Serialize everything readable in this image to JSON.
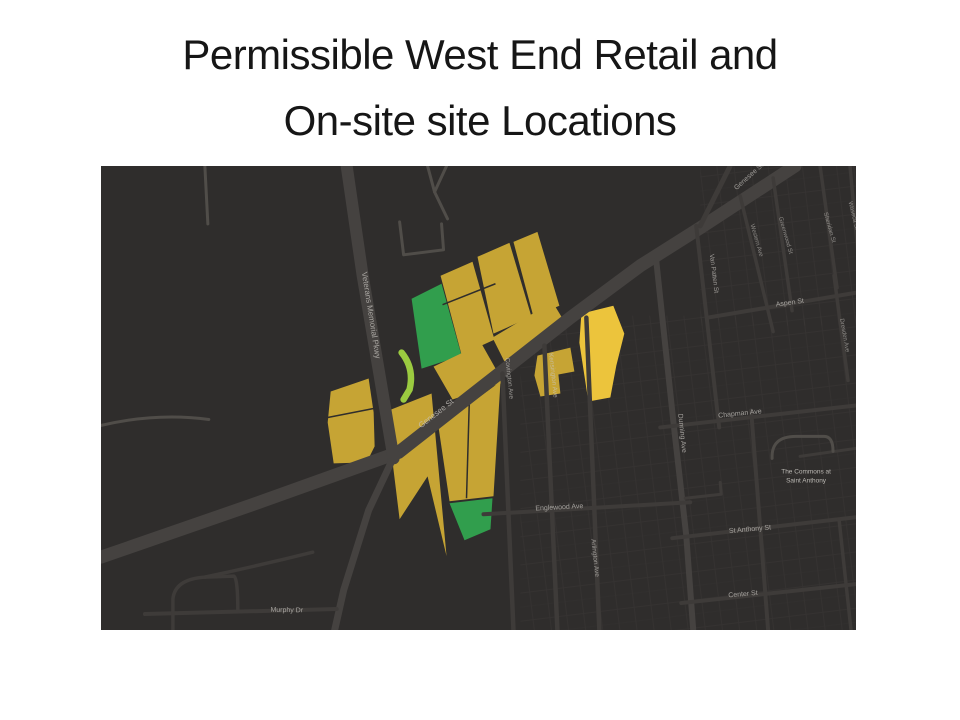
{
  "slide": {
    "title_line1": "Permissible West End Retail and",
    "title_line2": "On-site site Locations"
  },
  "map": {
    "colors": {
      "background": "#2f2d2c",
      "road_major": "#454240",
      "road_minor": "#3e3b39",
      "road_faint": "#504d49",
      "block_grid": "#3a3736",
      "label": "#c9c6c1",
      "gold": "#c6a434",
      "yellow": "#ecc43c",
      "green": "#319e4d",
      "lightgreen": "#9bcb40"
    },
    "textures": [
      {
        "name": "blocks-bottom-center",
        "x": 420,
        "y": 150,
        "w": 336,
        "h": 315
      },
      {
        "name": "blocks-top-right",
        "x": 600,
        "y": 0,
        "w": 156,
        "h": 160
      }
    ],
    "parcels": [
      {
        "name": "parcel-green-upper",
        "fill": "green",
        "pts": "311,133 341,118 361,190 321,203"
      },
      {
        "name": "parcel-gold-a",
        "fill": "gold",
        "pts": "340,110 372,96 394,174 361,189"
      },
      {
        "name": "parcel-gold-b",
        "fill": "gold",
        "pts": "377,91 409,77 431,151 393,168"
      },
      {
        "name": "parcel-gold-c",
        "fill": "gold",
        "pts": "413,76 437,66 459,140 433,151"
      },
      {
        "name": "parcel-gold-d",
        "fill": "gold",
        "pts": "392,172 452,136 464,156 404,196"
      },
      {
        "name": "parcel-gold-e",
        "fill": "gold",
        "pts": "333,201 381,178 403,217 352,234"
      },
      {
        "name": "parcel-gold-f",
        "fill": "gold",
        "pts": "437,190 470,182 474,206 458,209 460,228 440,231 434,210"
      },
      {
        "name": "parcel-yellow-bright",
        "fill": "yellow",
        "pts": "481,148 513,140 524,168 516,200 510,232 488,236 479,177"
      },
      {
        "name": "parcel-gold-h",
        "fill": "gold",
        "pts": "230,226 268,213 273,247 274,281 266,297 233,298 227,257"
      },
      {
        "name": "parcel-gold-i",
        "fill": "gold",
        "pts": "283,247 331,228 346,391 327,311 299,354 291,289"
      },
      {
        "name": "parcel-gold-j",
        "fill": "gold",
        "pts": "338,262 400,216 393,331 349,336"
      },
      {
        "name": "parcel-green-lower",
        "fill": "green",
        "pts": "349,338 392,333 390,364 364,375"
      }
    ],
    "sliver": {
      "name": "parcel-lightgreen-sliver",
      "d": "M301,187 Q314,203 309,224 L303,234",
      "w": 6.5,
      "fill": "lightgreen"
    },
    "splits": [
      "M227,252 L273,243",
      "M369,229 L366,333",
      "M342,139 L395,118"
    ],
    "roads": [
      {
        "name": "genesee-st",
        "d": "M0,392 L150,340 L298,287 L470,152 L540,100 L600,62 L695,0",
        "w": 13,
        "c": "road_major"
      },
      {
        "name": "veterans-memorial-pkwy-upper",
        "d": "M246,0 L262,110 L279,210 L293,293",
        "w": 12,
        "c": "road_major"
      },
      {
        "name": "veterans-memorial-pkwy-lower",
        "d": "M291,296 L268,345 L243,425 L234,465",
        "w": 7,
        "c": "road_major"
      },
      {
        "name": "genesee-branch",
        "d": "M600,60 L630,0",
        "w": 5,
        "c": "road_minor"
      },
      {
        "name": "covington-ave",
        "d": "M402,208 L413,465",
        "w": 4.5,
        "c": "road_minor"
      },
      {
        "name": "kensington-ave",
        "d": "M444,180 L457,465",
        "w": 4.5,
        "c": "road_minor"
      },
      {
        "name": "arlington-ave",
        "d": "M486,152 L499,465",
        "w": 4.5,
        "c": "road_minor"
      },
      {
        "name": "dunning-ave",
        "d": "M556,95 L573,255 L586,370 L593,465",
        "w": 6,
        "c": "road_major"
      },
      {
        "name": "englewood-ave",
        "d": "M383,349 L590,337",
        "w": 4,
        "c": "road_minor"
      },
      {
        "name": "chapman-ave",
        "d": "M560,262 L756,240",
        "w": 4,
        "c": "road_minor"
      },
      {
        "name": "st-anthony-st",
        "d": "M572,373 L756,352",
        "w": 4,
        "c": "road_minor"
      },
      {
        "name": "center-st",
        "d": "M581,438 L756,419",
        "w": 4,
        "c": "road_minor"
      },
      {
        "name": "aspen-st",
        "d": "M607,152 L756,127",
        "w": 4,
        "c": "road_minor"
      },
      {
        "name": "van-patten-st",
        "d": "M596,60 L619,262",
        "w": 4,
        "c": "road_minor"
      },
      {
        "name": "western-ave",
        "d": "M640,30 L673,166",
        "w": 3.5,
        "c": "road_minor"
      },
      {
        "name": "greenwood-st",
        "d": "M673,12 L692,145",
        "w": 3.5,
        "c": "road_minor"
      },
      {
        "name": "sheridan-st",
        "d": "M720,0 L737,122",
        "w": 3.5,
        "c": "road_minor"
      },
      {
        "name": "dresden-ave",
        "d": "M734,110 L748,215",
        "w": 3.5,
        "c": "road_minor"
      },
      {
        "name": "waseca-st",
        "d": "M750,0 L760,110",
        "w": 3.5,
        "c": "road_minor"
      },
      {
        "name": "right-vertical-st",
        "d": "M651,245 L668,465",
        "w": 4,
        "c": "road_minor"
      },
      {
        "name": "right-lower-vertical-st",
        "d": "M739,354 L751,465",
        "w": 3.5,
        "c": "road_minor"
      },
      {
        "name": "right-mid-horizontal-st",
        "d": "M700,291 L756,283",
        "w": 3,
        "c": "road_minor"
      },
      {
        "name": "st-anthony-hook-st",
        "d": "M585,333 L621,329 L620,317",
        "w": 3,
        "c": "road_minor"
      },
      {
        "name": "murphy-dr",
        "d": "M44,449 L236,444",
        "w": 4,
        "c": "road_minor"
      },
      {
        "name": "bottomleft-loop-rd",
        "d": "M72,465 L72,434 Q74,414 104,412 L133,411 Q137,413 137,446",
        "w": 3.5,
        "c": "road_minor"
      },
      {
        "name": "bottomleft-spur-rd",
        "d": "M104,412 Q160,400 212,387",
        "w": 3.5,
        "c": "road_minor"
      },
      {
        "name": "left-faint-curve-rd",
        "d": "M0,260 Q55,247 108,254",
        "w": 3,
        "c": "road_faint"
      },
      {
        "name": "topleft-faint-vert-rd",
        "d": "M104,0 L107,58",
        "w": 3,
        "c": "road_faint"
      },
      {
        "name": "top-u-rd",
        "d": "M299,56 L303,89 L343,84 L341,58",
        "w": 3,
        "c": "road_faint"
      },
      {
        "name": "top-y-rd",
        "d": "M327,0 L334,26 L347,53",
        "w": 3,
        "c": "road_faint"
      },
      {
        "name": "top-y-branch-rd",
        "d": "M346,0 L334,26",
        "w": 3,
        "c": "road_faint"
      },
      {
        "name": "commons-loop-rd",
        "d": "M672,293 Q671,271 696,271 L724,271 Q733,271 733,286",
        "w": 3,
        "c": "road_faint"
      }
    ],
    "labels": [
      {
        "name": "label-veterans-memorial-pkwy",
        "text": "Veterans Memorial Pkwy",
        "x": 268,
        "y": 150,
        "r": 81,
        "s": 8,
        "o": 0.75
      },
      {
        "name": "label-genesee-st",
        "text": "Genesee St",
        "x": 337,
        "y": 250,
        "r": -38,
        "s": 8,
        "o": 0.8
      },
      {
        "name": "label-genesee-st-top",
        "text": "Genesee St",
        "x": 650,
        "y": 12,
        "r": -42,
        "s": 7,
        "o": 0.7
      },
      {
        "name": "label-covington-ave",
        "text": "Covington Ave",
        "x": 407,
        "y": 213,
        "r": 84,
        "s": 6.5,
        "o": 0.7
      },
      {
        "name": "label-kensington-ave",
        "text": "Kensington Ave",
        "x": 451,
        "y": 210,
        "r": 84,
        "s": 6.5,
        "o": 0.7
      },
      {
        "name": "label-arlington-ave",
        "text": "Arlington Ave",
        "x": 493,
        "y": 393,
        "r": 84,
        "s": 6.5,
        "o": 0.7
      },
      {
        "name": "label-dunning-ave",
        "text": "Dunning Ave",
        "x": 580,
        "y": 268,
        "r": 84,
        "s": 7,
        "o": 0.75
      },
      {
        "name": "label-englewood-ave",
        "text": "Englewood Ave",
        "x": 459,
        "y": 344,
        "r": -3,
        "s": 7,
        "o": 0.75
      },
      {
        "name": "label-chapman-ave",
        "text": "Chapman Ave",
        "x": 640,
        "y": 250,
        "r": -6,
        "s": 7,
        "o": 0.75
      },
      {
        "name": "label-st-anthony-st",
        "text": "St Anthony St",
        "x": 650,
        "y": 366,
        "r": -5,
        "s": 7,
        "o": 0.75
      },
      {
        "name": "label-center-st",
        "text": "Center St",
        "x": 643,
        "y": 431,
        "r": -5,
        "s": 7,
        "o": 0.75
      },
      {
        "name": "label-aspen-st",
        "text": "Aspen St",
        "x": 690,
        "y": 139,
        "r": -8,
        "s": 7,
        "o": 0.75
      },
      {
        "name": "label-van-patten-st",
        "text": "Van Patten St",
        "x": 612,
        "y": 108,
        "r": 83,
        "s": 6.5,
        "o": 0.7
      },
      {
        "name": "label-western-ave",
        "text": "Western Ave",
        "x": 655,
        "y": 75,
        "r": 74,
        "s": 6,
        "o": 0.6
      },
      {
        "name": "label-greenwood-st",
        "text": "Greenwood St",
        "x": 684,
        "y": 70,
        "r": 74,
        "s": 6,
        "o": 0.6
      },
      {
        "name": "label-sheridan-st",
        "text": "Sheridan St",
        "x": 728,
        "y": 62,
        "r": 74,
        "s": 6,
        "o": 0.6
      },
      {
        "name": "label-dresden-ave",
        "text": "Dresden Ave",
        "x": 743,
        "y": 170,
        "r": 80,
        "s": 6,
        "o": 0.6
      },
      {
        "name": "label-waseca-st",
        "text": "Waseca St",
        "x": 752,
        "y": 50,
        "r": 76,
        "s": 6,
        "o": 0.6
      },
      {
        "name": "label-murphy-dr",
        "text": "Murphy Dr",
        "x": 186,
        "y": 447,
        "r": 1,
        "s": 7,
        "o": 0.75
      },
      {
        "name": "label-commons-line1",
        "text": "The Commons at",
        "x": 706,
        "y": 308,
        "r": 0,
        "s": 6.5,
        "o": 0.9
      },
      {
        "name": "label-commons-line2",
        "text": "Saint Anthony",
        "x": 706,
        "y": 317,
        "r": 0,
        "s": 6.5,
        "o": 0.9
      }
    ]
  }
}
